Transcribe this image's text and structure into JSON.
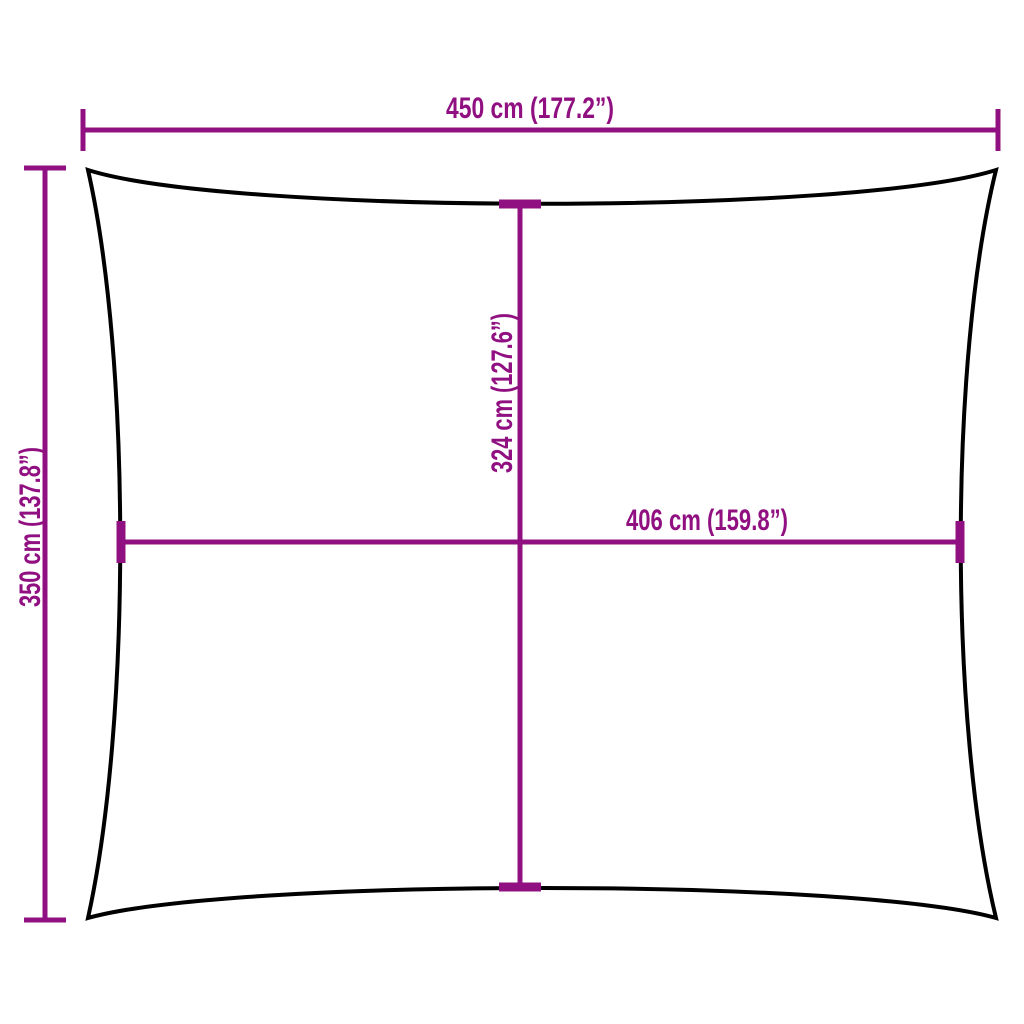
{
  "diagram": {
    "kind": "product-dimension-diagram",
    "shape": "rectangle-with-concave-edges",
    "colors": {
      "dimension": "#911081",
      "outline": "#000000",
      "background": "#FFFFFF"
    },
    "dimensions": {
      "top_width": {
        "label": "450 cm (177.2”)",
        "cm": 450,
        "inches": 177.2
      },
      "left_height": {
        "label": "350 cm (137.8”)",
        "cm": 350,
        "inches": 137.8
      },
      "inner_height": {
        "label": "324 cm (127.6”)",
        "cm": 324,
        "inches": 127.6
      },
      "inner_width": {
        "label": "406 cm (159.8”)",
        "cm": 406,
        "inches": 159.8
      }
    }
  }
}
